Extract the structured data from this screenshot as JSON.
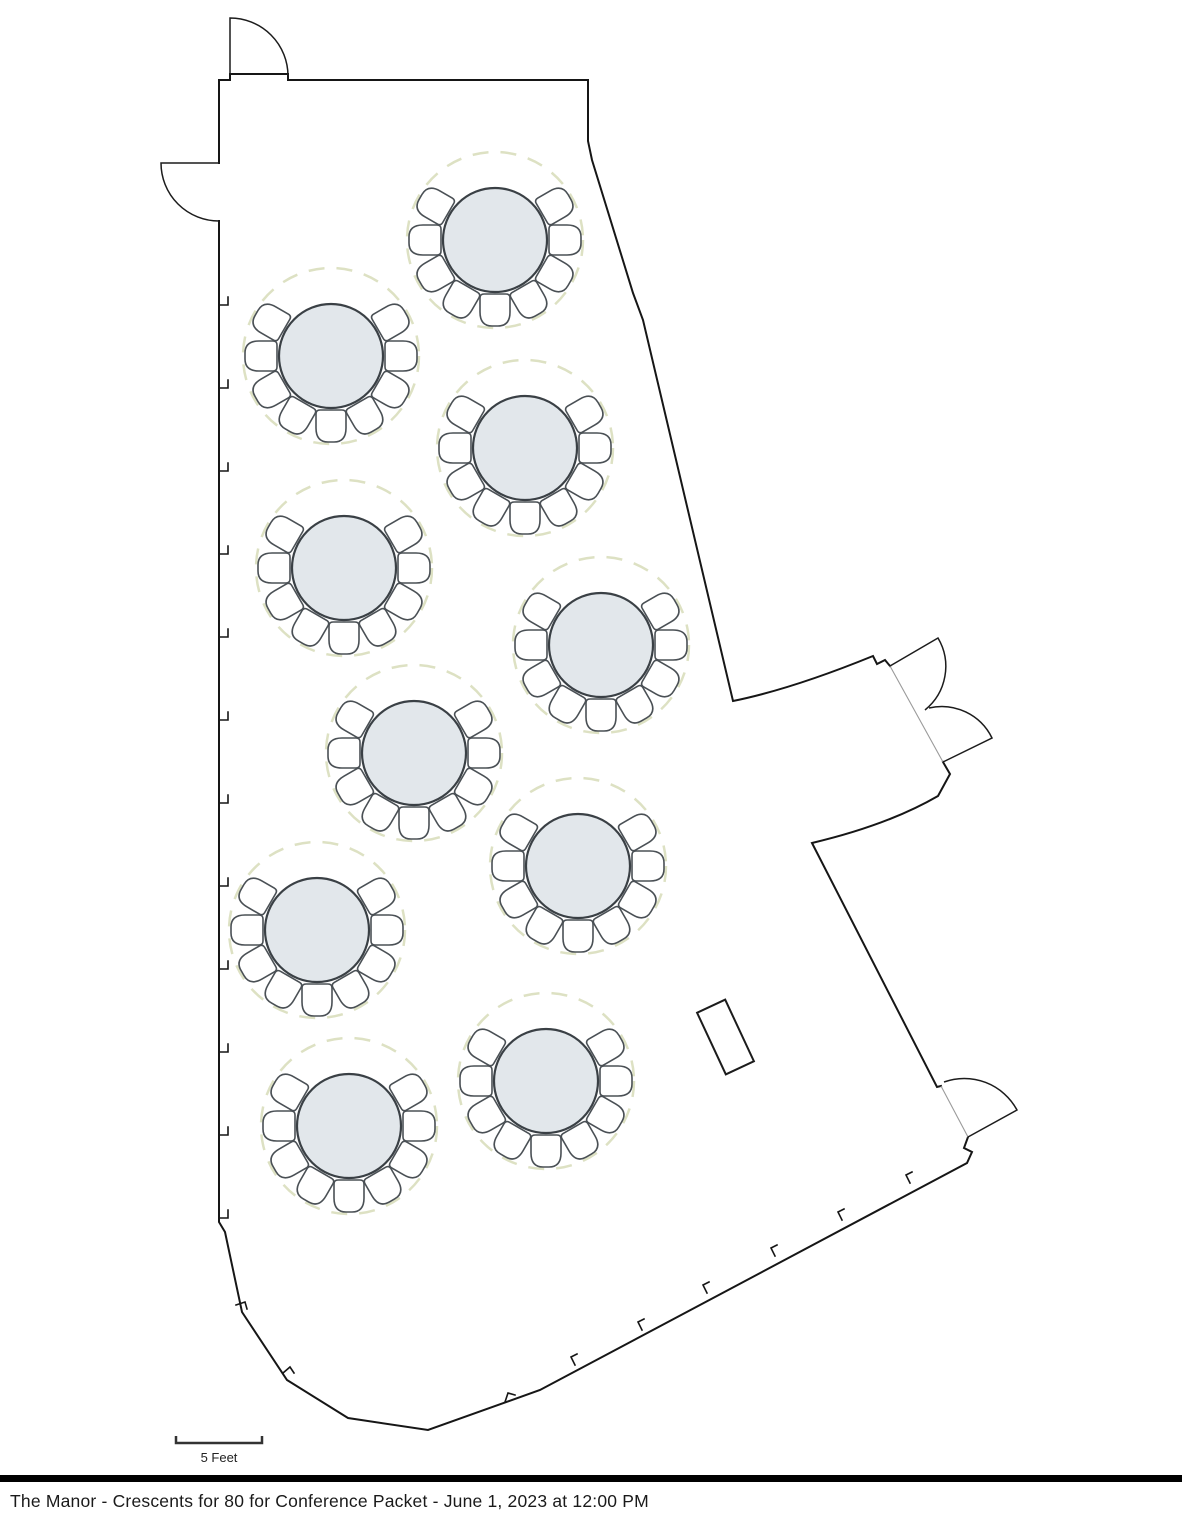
{
  "title_bar": {
    "text": "The Manor - Crescents for 80 for Conference Packet - June 1, 2023 at 12:00 PM"
  },
  "scale": {
    "label": "5 Feet",
    "feet": 5,
    "bar_px": 86
  },
  "floor_plan": {
    "room_name": "The Manor",
    "setup": "Crescent rounds",
    "wall_color": "#161616",
    "opening_line_color": "#9a9a9a",
    "table_fill": "#e2e7eb",
    "table_stroke": "#3a4045",
    "chair_fill": "#ffffff",
    "chair_stroke": "#4a5055",
    "spacing_ring_color": "#dde1c3",
    "table_radius": 52,
    "chair_ring_radius": 68,
    "spacing_ring_radius": 88,
    "chairs_per_table": 9,
    "chair_angles_deg": [
      60,
      90,
      120,
      150,
      180,
      210,
      240,
      270,
      300
    ],
    "tables": [
      {
        "id": "table-1",
        "cx": 495,
        "cy": 240
      },
      {
        "id": "table-2",
        "cx": 331,
        "cy": 356
      },
      {
        "id": "table-3",
        "cx": 525,
        "cy": 448
      },
      {
        "id": "table-4",
        "cx": 344,
        "cy": 568
      },
      {
        "id": "table-5",
        "cx": 601,
        "cy": 645
      },
      {
        "id": "table-6",
        "cx": 414,
        "cy": 753
      },
      {
        "id": "table-7",
        "cx": 578,
        "cy": 866
      },
      {
        "id": "table-8",
        "cx": 317,
        "cy": 930
      },
      {
        "id": "table-9",
        "cx": 546,
        "cy": 1081
      },
      {
        "id": "table-10",
        "cx": 349,
        "cy": 1126
      }
    ],
    "podium": {
      "cx": 725.5,
      "cy": 1037,
      "w": 31,
      "h": 68,
      "rotate_deg": -25
    }
  }
}
